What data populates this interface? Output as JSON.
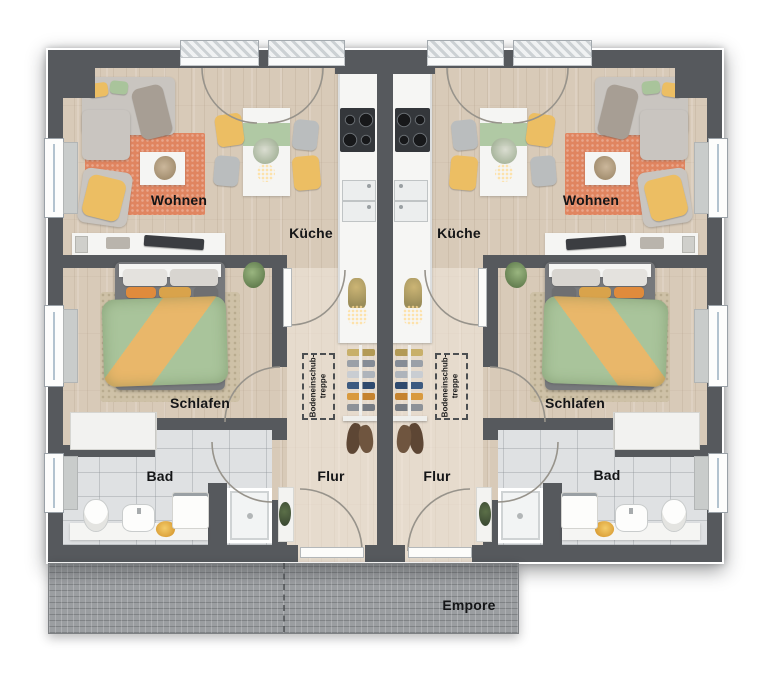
{
  "units": {
    "left": {
      "living": "Wohnen",
      "kitchen": "Küche",
      "bedroom": "Schlafen",
      "bathroom": "Bad",
      "hallway": "Flur",
      "attic_hatch": {
        "line1": "Bodeneinschub-",
        "line2": "treppe"
      }
    },
    "right": {
      "living": "Wohnen",
      "kitchen": "Küche",
      "bedroom": "Schlafen",
      "bathroom": "Bad",
      "hallway": "Flur",
      "attic_hatch": {
        "line1": "Bodeneinschub-",
        "line2": "treppe"
      }
    }
  },
  "gallery": {
    "label": "Empore"
  },
  "colors": {
    "wall": "#56595d",
    "floor_wood": "#d8cab8",
    "tile": "#dfe1e3",
    "empore": "#9b9ea1",
    "rug_living": "#e08560",
    "rug_bedroom": "#cec1a7",
    "sofa": "#c9c5c0",
    "accent_yellow": "#ecbe63",
    "accent_green": "#a9c49b",
    "duvet_orange": "#e9b76a",
    "counter": "#f6f6f4",
    "cooktop": "#34373b",
    "coat_brown": "#5d4634",
    "label_ink": "#141517"
  }
}
